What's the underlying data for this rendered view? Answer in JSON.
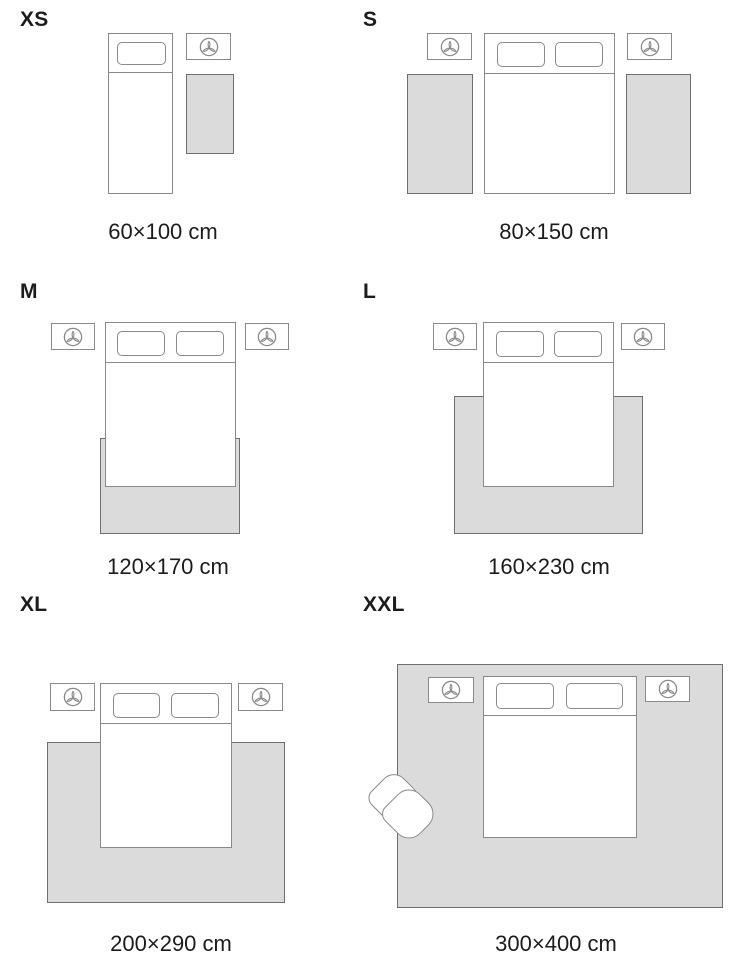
{
  "sizes": [
    {
      "code": "XS",
      "dimensions": "60×100 cm"
    },
    {
      "code": "S",
      "dimensions": "80×150 cm"
    },
    {
      "code": "M",
      "dimensions": "120×170 cm"
    },
    {
      "code": "L",
      "dimensions": "160×230 cm"
    },
    {
      "code": "XL",
      "dimensions": "200×290 cm"
    },
    {
      "code": "XXL",
      "dimensions": "300×400 cm"
    }
  ],
  "nightstand_icon": "plant-icon",
  "colors": {
    "rug_fill": "#dbdbdb",
    "rug_outline": "#6f6f6f",
    "furniture_outline": "#8a8a8a",
    "text": "#1c1c1e",
    "background": "#ffffff"
  }
}
